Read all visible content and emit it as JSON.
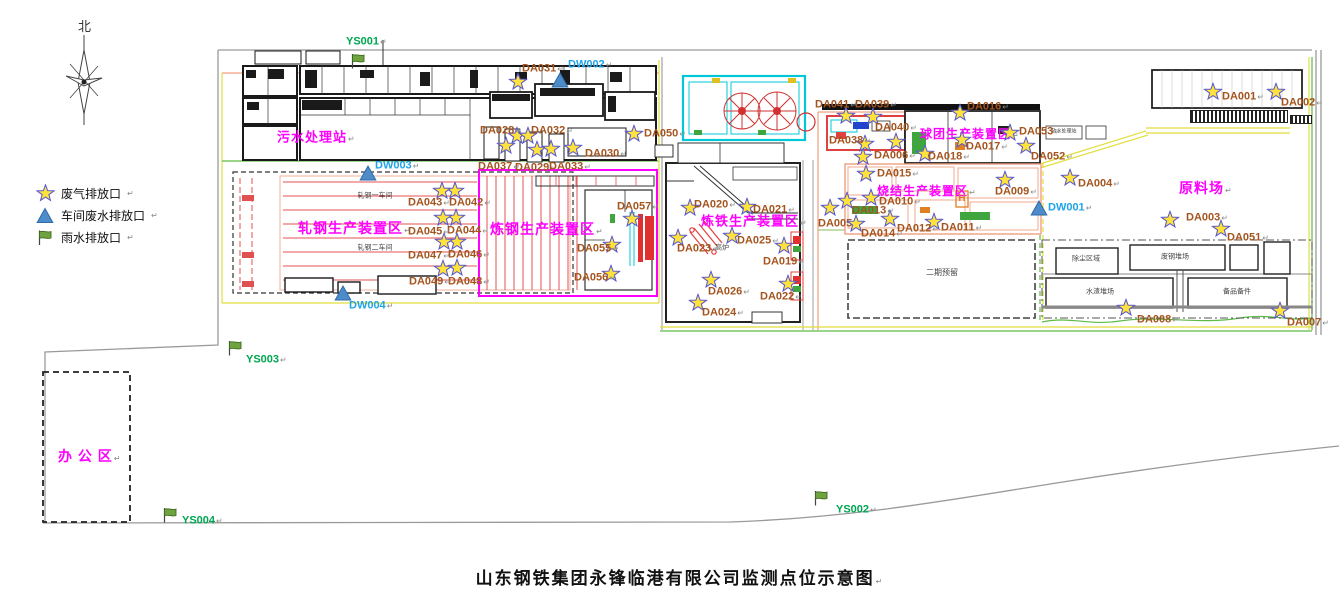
{
  "title": {
    "text": "山东钢铁集团永锋临港有限公司监测点位示意图"
  },
  "compass": {
    "label": "北"
  },
  "marks": {
    "ret": "↵"
  },
  "legend": {
    "items": [
      {
        "icon": "star",
        "label": "废气排放口"
      },
      {
        "icon": "triangle",
        "label": "车间废水排放口"
      },
      {
        "icon": "flag",
        "label": "雨水排放口"
      }
    ]
  },
  "colors": {
    "gas_label": "#A4541E",
    "wastewater_label": "#1FA3E8",
    "rainwater_label": "#00A651",
    "zone_label": "#FF00FF",
    "star_fill": "#FFE23B",
    "star_stroke": "#5A5AD0",
    "triangle_fill": "#4D8BC9",
    "triangle_stroke": "#2F6BA8",
    "flag_fill": "#6FA33F",
    "flag_stroke": "#3D6B1F"
  },
  "zones": [
    {
      "label": "污水处理站",
      "x": 277,
      "y": 137,
      "size": 13
    },
    {
      "label": "轧钢生产装置区",
      "x": 298,
      "y": 228,
      "size": 14
    },
    {
      "label": "炼钢生产装置区",
      "x": 490,
      "y": 229,
      "size": 14
    },
    {
      "label": "炼铁生产装置区",
      "x": 701,
      "y": 221,
      "size": 13
    },
    {
      "label": "烧结生产装置区",
      "x": 877,
      "y": 191,
      "size": 12
    },
    {
      "label": "球团生产装置区",
      "x": 920,
      "y": 134,
      "size": 12
    },
    {
      "label": "原料场",
      "x": 1179,
      "y": 188,
      "size": 14
    },
    {
      "label": "办 公 区",
      "x": 58,
      "y": 456,
      "size": 14
    }
  ],
  "area_labels": [
    {
      "text": "轧钢一车间",
      "x": 375,
      "y": 196,
      "size": 7
    },
    {
      "text": "轧钢二车间",
      "x": 375,
      "y": 248,
      "size": 7
    },
    {
      "text": "高炉",
      "x": 722,
      "y": 248,
      "size": 7
    },
    {
      "text": "二期预留",
      "x": 942,
      "y": 273,
      "size": 8
    },
    {
      "text": "软水处理站",
      "x": 1064,
      "y": 132,
      "size": 5
    },
    {
      "text": "除尘区域",
      "x": 1086,
      "y": 259,
      "size": 7
    },
    {
      "text": "废钢堆场",
      "x": 1175,
      "y": 257,
      "size": 7
    },
    {
      "text": "水渣堆场",
      "x": 1100,
      "y": 292,
      "size": 7
    },
    {
      "text": "备品备件",
      "x": 1237,
      "y": 292,
      "size": 7
    },
    {
      "text": "H",
      "x": 962,
      "y": 199,
      "size": 10,
      "color": "#E07820"
    }
  ],
  "markers": {
    "gas": [
      {
        "id": "DA001",
        "sx": 1213,
        "sy": 92,
        "lx": 1222,
        "ly": 97
      },
      {
        "id": "DA002",
        "sx": 1276,
        "sy": 92,
        "lx": 1281,
        "ly": 103
      },
      {
        "id": "DA003",
        "sx": 1170,
        "sy": 220,
        "lx": 1186,
        "ly": 218
      },
      {
        "id": "DA004",
        "sx": 1070,
        "sy": 178,
        "lx": 1078,
        "ly": 184
      },
      {
        "id": "DA005",
        "sx": 830,
        "sy": 208,
        "lx": 818,
        "ly": 224
      },
      {
        "id": "DA006",
        "sx": 863,
        "sy": 157,
        "lx": 874,
        "ly": 156
      },
      {
        "id": "DA007",
        "sx": 1280,
        "sy": 311,
        "lx": 1287,
        "ly": 323
      },
      {
        "id": "DA008",
        "sx": 1126,
        "sy": 308,
        "lx": 1137,
        "ly": 320
      },
      {
        "id": "DA009",
        "sx": 1005,
        "sy": 180,
        "lx": 995,
        "ly": 192
      },
      {
        "id": "DA010",
        "sx": 871,
        "sy": 198,
        "lx": 879,
        "ly": 202
      },
      {
        "id": "DA011",
        "sx": 934,
        "sy": 222,
        "lx": 941,
        "ly": 228
      },
      {
        "id": "DA012",
        "sx": 890,
        "sy": 219,
        "lx": 897,
        "ly": 229
      },
      {
        "id": "DA013",
        "sx": 847,
        "sy": 201,
        "lx": 852,
        "ly": 211
      },
      {
        "id": "DA014",
        "sx": 856,
        "sy": 224,
        "lx": 861,
        "ly": 234
      },
      {
        "id": "DA015",
        "sx": 866,
        "sy": 174,
        "lx": 877,
        "ly": 174
      },
      {
        "id": "DA016",
        "sx": 960,
        "sy": 113,
        "lx": 967,
        "ly": 107
      },
      {
        "id": "DA017",
        "sx": 962,
        "sy": 140,
        "lx": 966,
        "ly": 147
      },
      {
        "id": "DA018",
        "sx": 925,
        "sy": 154,
        "lx": 928,
        "ly": 157
      },
      {
        "id": "DA019",
        "sx": 784,
        "sy": 246,
        "lx": 763,
        "ly": 262
      },
      {
        "id": "DA020",
        "sx": 690,
        "sy": 208,
        "lx": 694,
        "ly": 205
      },
      {
        "id": "DA021",
        "sx": 747,
        "sy": 207,
        "lx": 753,
        "ly": 210
      },
      {
        "id": "DA022",
        "sx": 788,
        "sy": 284,
        "lx": 760,
        "ly": 297
      },
      {
        "id": "DA023",
        "sx": 678,
        "sy": 238,
        "lx": 677,
        "ly": 249
      },
      {
        "id": "DA024",
        "sx": 698,
        "sy": 303,
        "lx": 702,
        "ly": 313
      },
      {
        "id": "DA025",
        "sx": 732,
        "sy": 236,
        "lx": 737,
        "ly": 241
      },
      {
        "id": "DA026",
        "sx": 711,
        "sy": 280,
        "lx": 708,
        "ly": 292
      },
      {
        "id": "DA028",
        "sx": 517,
        "sy": 136,
        "lx": 480,
        "ly": 131
      },
      {
        "id": "DA029",
        "sx": 537,
        "sy": 150,
        "lx": 515,
        "ly": 168
      },
      {
        "id": "DA030",
        "sx": 573,
        "sy": 148,
        "lx": 585,
        "ly": 154
      },
      {
        "id": "DA031",
        "sx": 518,
        "sy": 82,
        "lx": 522,
        "ly": 69
      },
      {
        "id": "DA032",
        "sx": 528,
        "sy": 136,
        "lx": 531,
        "ly": 131
      },
      {
        "id": "DA033",
        "sx": 551,
        "sy": 149,
        "lx": 549,
        "ly": 167
      },
      {
        "id": "DA037",
        "sx": 506,
        "sy": 146,
        "lx": 478,
        "ly": 167
      },
      {
        "id": "DA038",
        "sx": 865,
        "sy": 144,
        "lx": 829,
        "ly": 141
      },
      {
        "id": "DA039",
        "sx": 873,
        "sy": 117,
        "lx": 855,
        "ly": 105
      },
      {
        "id": "DA040",
        "sx": 896,
        "sy": 142,
        "lx": 875,
        "ly": 128
      },
      {
        "id": "DA041",
        "sx": 846,
        "sy": 116,
        "lx": 815,
        "ly": 105
      },
      {
        "id": "DA042",
        "sx": 455,
        "sy": 191,
        "lx": 449,
        "ly": 203
      },
      {
        "id": "DA043",
        "sx": 442,
        "sy": 191,
        "lx": 408,
        "ly": 203
      },
      {
        "id": "DA044",
        "sx": 456,
        "sy": 218,
        "lx": 447,
        "ly": 231
      },
      {
        "id": "DA045",
        "sx": 443,
        "sy": 218,
        "lx": 408,
        "ly": 232
      },
      {
        "id": "DA046",
        "sx": 457,
        "sy": 242,
        "lx": 448,
        "ly": 255
      },
      {
        "id": "DA047",
        "sx": 444,
        "sy": 242,
        "lx": 408,
        "ly": 256
      },
      {
        "id": "DA048",
        "sx": 457,
        "sy": 268,
        "lx": 448,
        "ly": 282
      },
      {
        "id": "DA049",
        "sx": 443,
        "sy": 269,
        "lx": 409,
        "ly": 282
      },
      {
        "id": "DA050",
        "sx": 634,
        "sy": 134,
        "lx": 644,
        "ly": 134
      },
      {
        "id": "DA051",
        "sx": 1221,
        "sy": 229,
        "lx": 1227,
        "ly": 238
      },
      {
        "id": "DA052",
        "sx": 1026,
        "sy": 146,
        "lx": 1031,
        "ly": 157
      },
      {
        "id": "DA053",
        "sx": 1010,
        "sy": 133,
        "lx": 1019,
        "ly": 132
      },
      {
        "id": "DA055",
        "sx": 612,
        "sy": 245,
        "lx": 577,
        "ly": 249
      },
      {
        "id": "DA056",
        "sx": 611,
        "sy": 274,
        "lx": 574,
        "ly": 278
      },
      {
        "id": "DA057",
        "sx": 632,
        "sy": 219,
        "lx": 617,
        "ly": 207
      }
    ],
    "wastewater": [
      {
        "id": "DW001",
        "sx": 1039,
        "sy": 208,
        "lx": 1048,
        "ly": 208
      },
      {
        "id": "DW002",
        "sx": 560,
        "sy": 80,
        "lx": 568,
        "ly": 65
      },
      {
        "id": "DW003",
        "sx": 368,
        "sy": 173,
        "lx": 375,
        "ly": 166
      },
      {
        "id": "DW004",
        "sx": 343,
        "sy": 293,
        "lx": 349,
        "ly": 306
      }
    ],
    "rainwater": [
      {
        "id": "YS001",
        "sx": 359,
        "sy": 61,
        "lx": 346,
        "ly": 42
      },
      {
        "id": "YS002",
        "sx": 822,
        "sy": 498,
        "lx": 836,
        "ly": 510
      },
      {
        "id": "YS003",
        "sx": 236,
        "sy": 348,
        "lx": 246,
        "ly": 360
      },
      {
        "id": "YS004",
        "sx": 171,
        "sy": 515,
        "lx": 182,
        "ly": 521
      }
    ]
  }
}
